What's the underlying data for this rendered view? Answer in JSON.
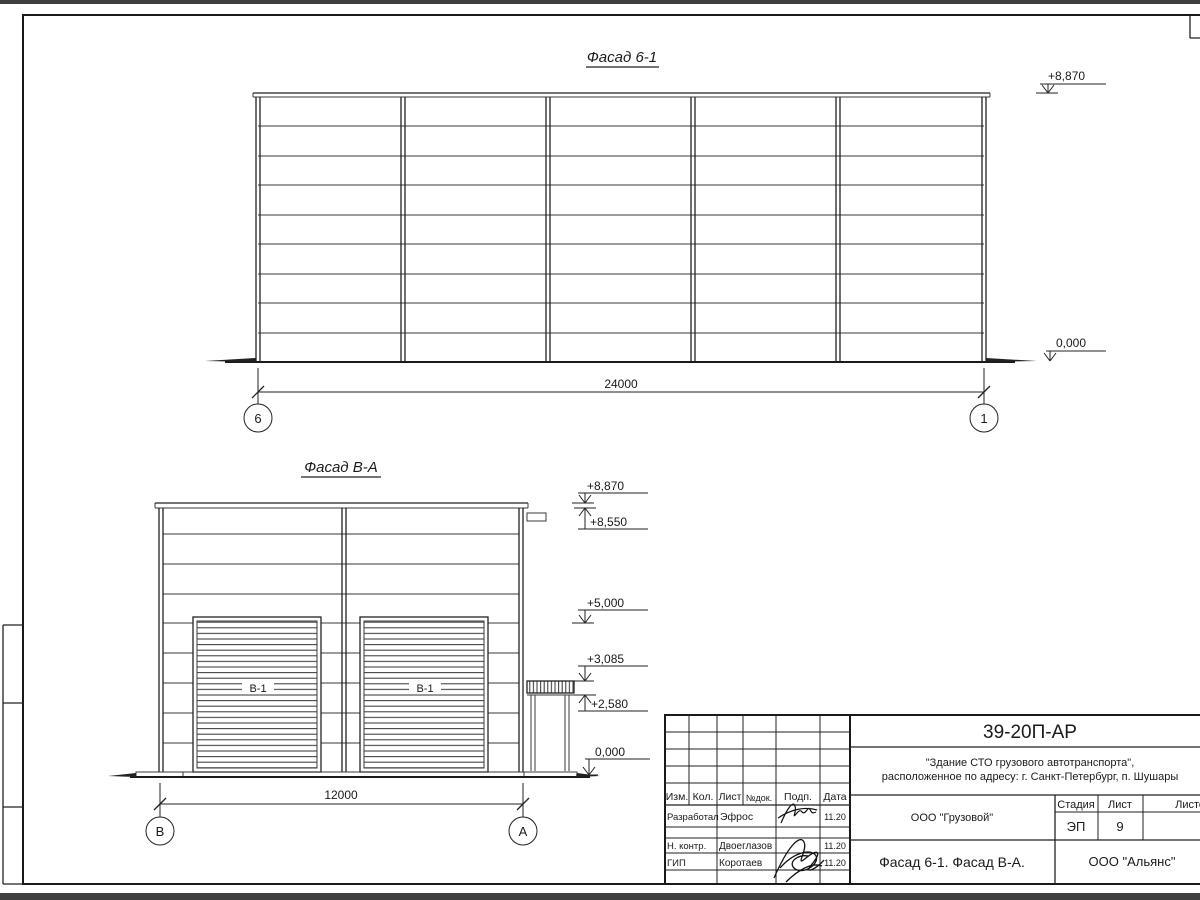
{
  "drawing": {
    "facade61": {
      "title": "Фасад 6-1",
      "elev_top": "+8,870",
      "elev_zero": "0,000",
      "dim": "24000",
      "axis_left": "6",
      "axis_right": "1"
    },
    "facadeVA": {
      "title": "Фасад В-А",
      "door_label": "В-1",
      "elev_8870": "+8,870",
      "elev_8550": "+8,550",
      "elev_5000": "+5,000",
      "elev_3085": "+3,085",
      "elev_2580": "+2,580",
      "elev_0": "0,000",
      "dim": "12000",
      "axis_left": "В",
      "axis_right": "А"
    }
  },
  "title_block": {
    "doc_number": "39-20П-АР",
    "project_line1": "\"Здание СТО грузового автотранспорта\",",
    "project_line2": "расположенное по адресу: г. Санкт-Петербург, п. Шушары",
    "col_izm": "Изм.",
    "col_kol": "Кол.",
    "col_list": "Лист",
    "col_doc": "№док.",
    "col_podp": "Подп.",
    "col_data": "Дата",
    "row1_role": "Разработал",
    "row1_name": "Эфрос",
    "row1_date": "11.20",
    "row2_role": "Н. контр.",
    "row2_name": "Двоеглазов",
    "row2_date": "11.20",
    "row3_role": "ГИП",
    "row3_name": "Коротаев",
    "row3_date": "11.20",
    "company": "ООО \"Грузовой\"",
    "stage_label": "Стадия",
    "list_label": "Лист",
    "listov_label": "Листов",
    "stage": "ЭП",
    "sheet_no": "9",
    "drawing_title": "Фасад 6-1. Фасад В-А.",
    "org": "ООО \"Альянс\""
  }
}
